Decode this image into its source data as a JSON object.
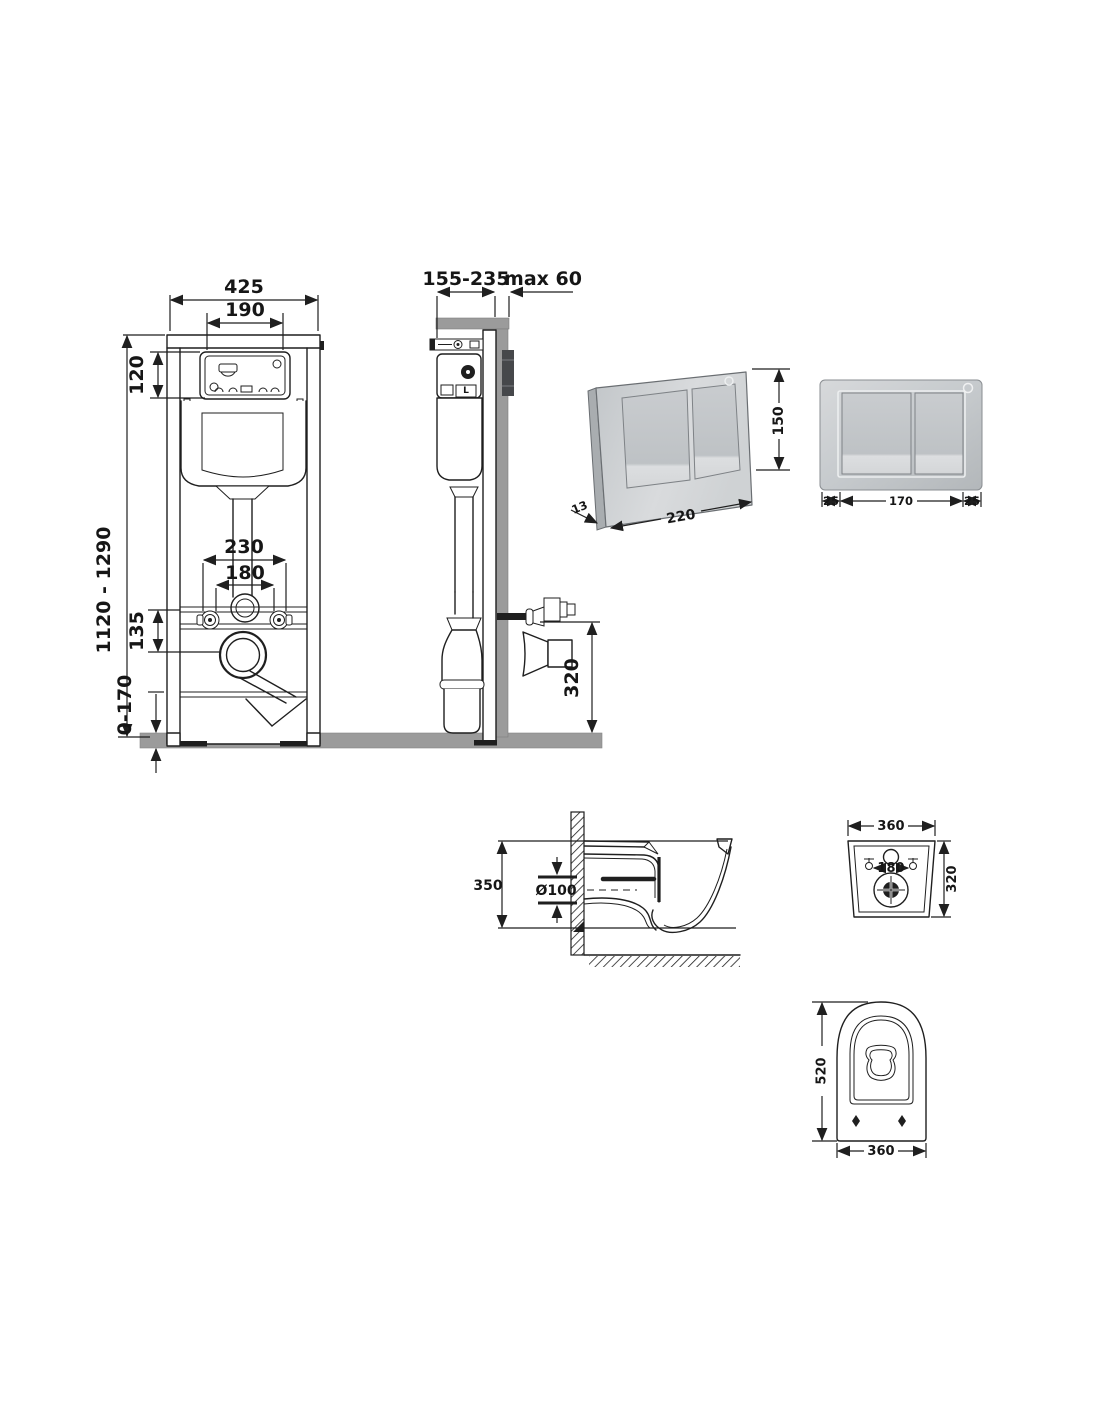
{
  "frame_front": {
    "width": "425",
    "window_width": "190",
    "window_height": "120",
    "height_range": "1120 - 1290",
    "fixing_span": "230",
    "outlet_span": "180",
    "outlet_drop": "135",
    "foot_adjust": "0-170"
  },
  "frame_side": {
    "depth_range": "155-235",
    "wall_max": "max 60",
    "outlet_height": "320",
    "valve_label": "L"
  },
  "plate_3d": {
    "width": "220",
    "height": "150",
    "thickness": "13"
  },
  "plate_front": {
    "margin_left": "25",
    "buttons_width": "170",
    "margin_right": "25"
  },
  "bowl_side": {
    "height": "350",
    "outlet_diameter": "Ø100"
  },
  "bowl_rear": {
    "width": "360",
    "height": "320",
    "fixing_span": "180"
  },
  "bowl_bottom": {
    "length": "520",
    "width": "360"
  },
  "colors": {
    "line": "#1f1f1f",
    "floor_wall_gray": "#9b9b9b",
    "plate_silver_light": "#dcdee0",
    "plate_silver_dark": "#b3b7ba",
    "recess_dark": "#46484b"
  }
}
